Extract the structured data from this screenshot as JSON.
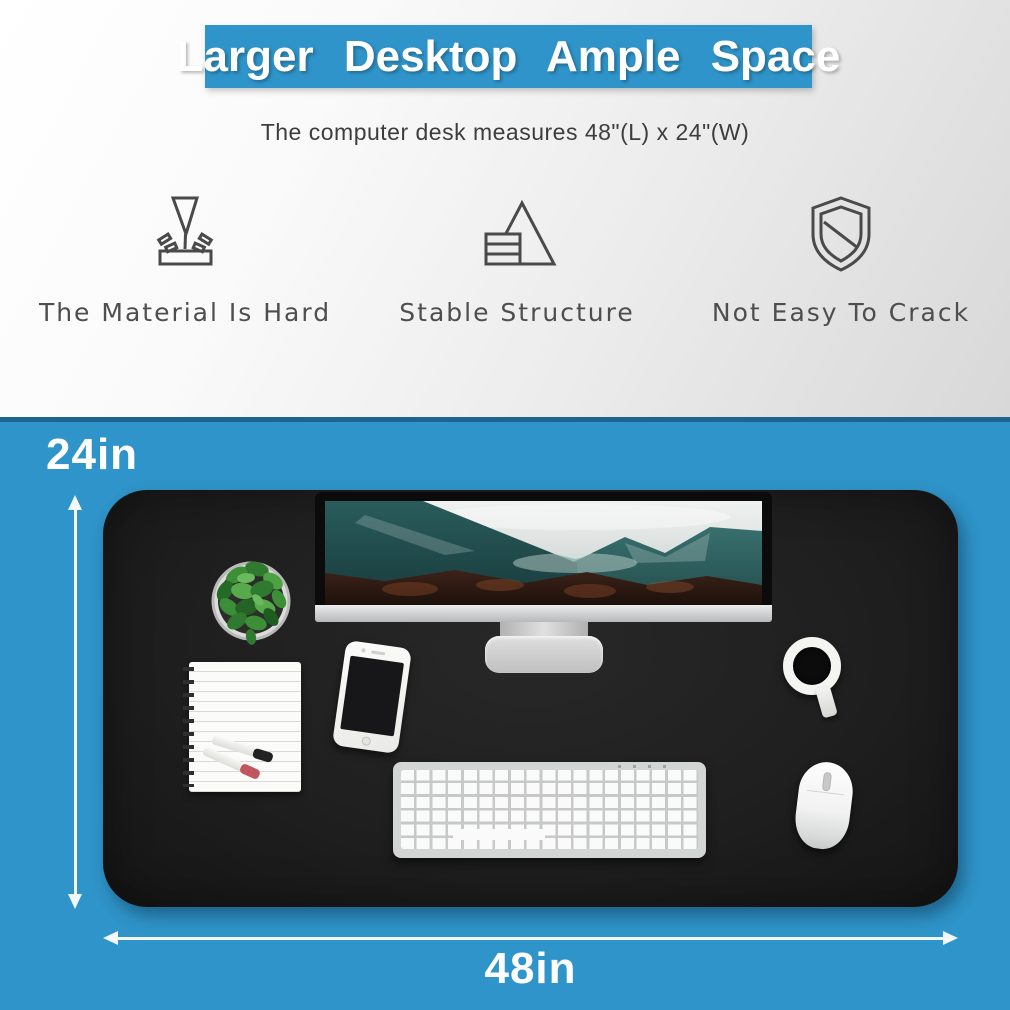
{
  "banner": {
    "title": "Larger Desktop Ample Space",
    "bg_color": "#2f94c9",
    "text_color": "#ffffff"
  },
  "subtitle": "The computer desk measures 48\"(L) x 24\"(W)",
  "features": [
    {
      "icon": "hardness-press-icon",
      "label": "The Material Is Hard"
    },
    {
      "icon": "stable-structure-icon",
      "label": "Stable Structure"
    },
    {
      "icon": "shield-icon",
      "label": "Not Easy To Crack"
    }
  ],
  "dimensions": {
    "height_label": "24in",
    "width_label": "48in"
  },
  "desk_scene": {
    "background_color": "#2f94c9",
    "surface_color": "#1f1f1f",
    "items": [
      "monitor",
      "plant",
      "notebook",
      "markers",
      "phone",
      "keyboard",
      "mouse",
      "coffee-cup"
    ]
  }
}
